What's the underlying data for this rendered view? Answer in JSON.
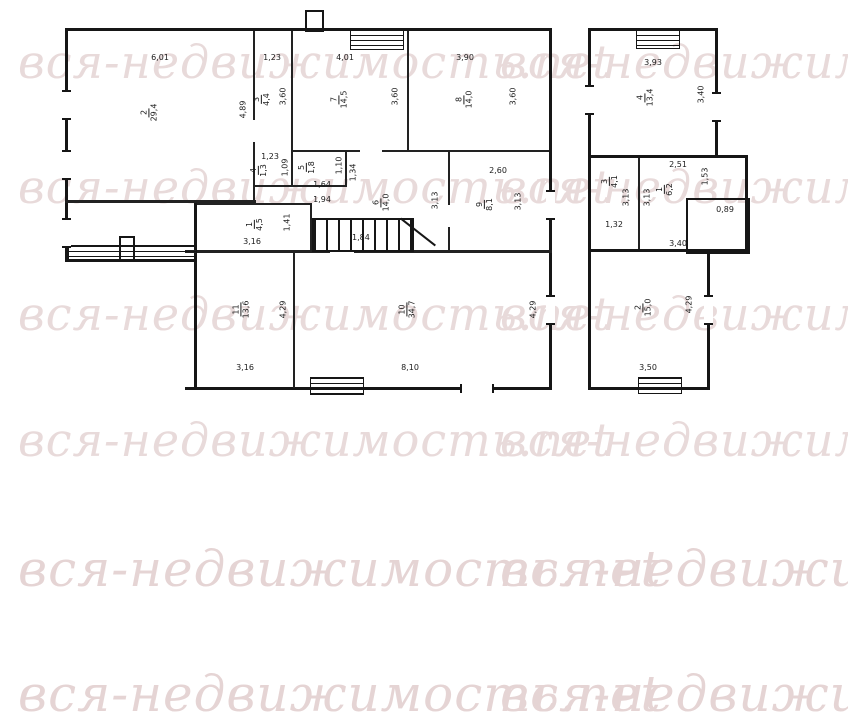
{
  "watermark": {
    "text": "вся-недвижимость.net"
  },
  "plan": {
    "b1": {
      "r2": {
        "num": "2",
        "area": "29,4",
        "top": "6,01",
        "side": "4,89"
      },
      "r3": {
        "num": "3",
        "area": "4,4",
        "top": "1,23",
        "side": "3,60"
      },
      "r7": {
        "num": "7",
        "area": "14,5",
        "top": "4,01",
        "side": "3,60"
      },
      "r8": {
        "num": "8",
        "area": "14,0",
        "top": "3,90",
        "side": "3,60"
      },
      "r4": {
        "num": "4",
        "area": "1,3",
        "top": "1,23",
        "side": "1,09"
      },
      "r5": {
        "num": "5",
        "area": "1,8",
        "bottom": "1,64",
        "side": "1,10",
        "side2": "1,34",
        "below": "1,94"
      },
      "r6": {
        "num": "6",
        "area": "14,0",
        "side": "3,13"
      },
      "r9": {
        "num": "9",
        "area": "8,1",
        "top": "2,60",
        "side": "3,13"
      },
      "r1": {
        "num": "1",
        "area": "4,5",
        "bottom": "3,16",
        "side": "1,41"
      },
      "r11": {
        "num": "11",
        "area": "13,6",
        "side": "4,29",
        "bottom": "3,16"
      },
      "r10": {
        "num": "10",
        "area": "34,7",
        "side": "4,29",
        "bottom": "8,10"
      },
      "stairs": {
        "label": "1,84"
      }
    },
    "b2": {
      "r4": {
        "num": "4",
        "area": "13,4",
        "top": "3,93",
        "side": "3,40"
      },
      "r3": {
        "num": "3",
        "area": "4,1",
        "side": "3,13",
        "bottom": "1,32"
      },
      "r1": {
        "num": "1",
        "area": "6,2",
        "top": "2,51",
        "side": "1,53",
        "side2": "3,13",
        "bottom": "3,40"
      },
      "entry": {
        "label": "0,89"
      },
      "r2": {
        "num": "2",
        "area": "15,0",
        "side": "4,29",
        "bottom": "3,50"
      }
    }
  }
}
